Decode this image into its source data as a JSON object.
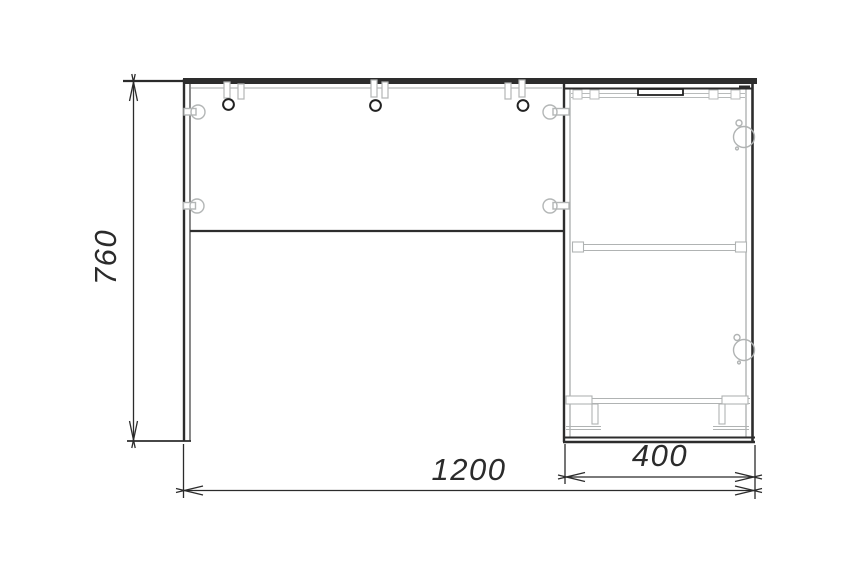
{
  "drawing": {
    "kind": "furniture-assembly-front-view",
    "dimensions": {
      "height_mm": "760",
      "total_width_mm": "1200",
      "cabinet_width_mm": "400"
    },
    "colors": {
      "line": "#2b2b2b",
      "detail": "#b3b6b6",
      "background": "#ffffff"
    }
  }
}
